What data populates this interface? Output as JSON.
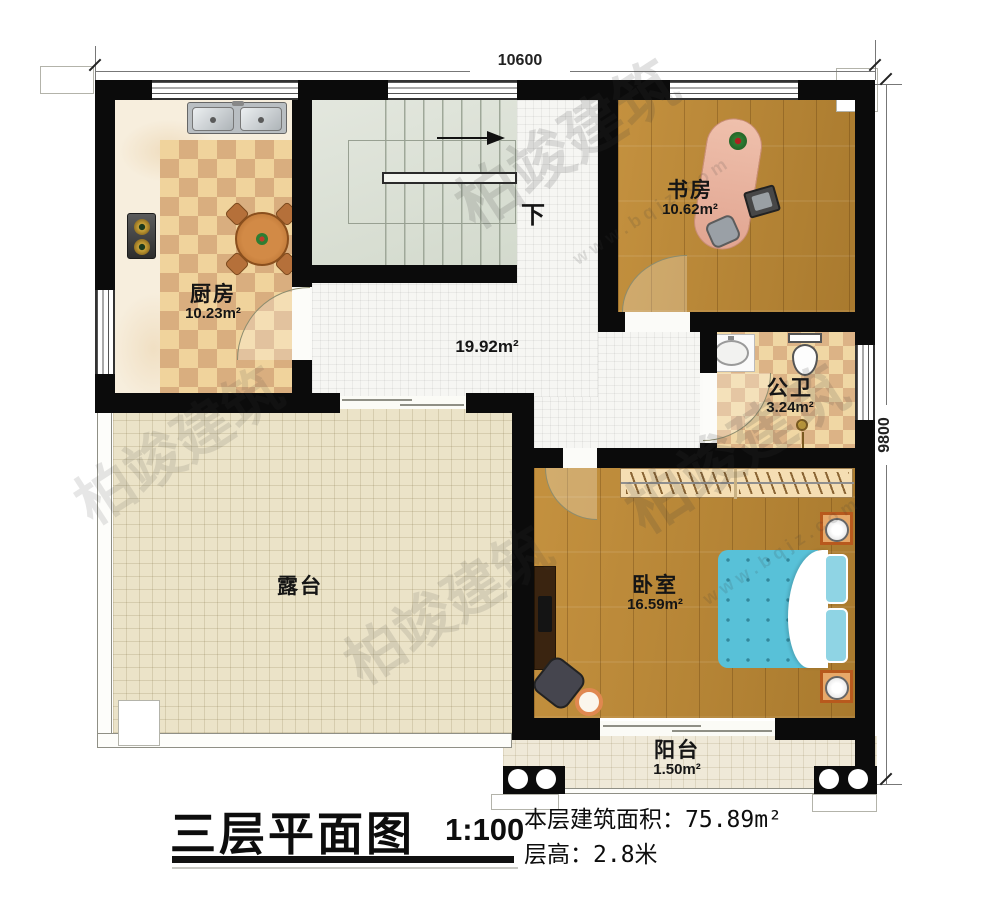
{
  "watermark": {
    "brand": "柏竣建筑",
    "url": "www.bqjz.com"
  },
  "dimensions": {
    "top": "10600",
    "right": "9800"
  },
  "stairs": {
    "direction_label": "下"
  },
  "rooms": {
    "kitchen": {
      "name": "厨房",
      "area": "10.23m²"
    },
    "study": {
      "name": "书房",
      "area": "10.62m²"
    },
    "bathroom": {
      "name": "公卫",
      "area": "3.24m²"
    },
    "bedroom": {
      "name": "卧室",
      "area": "16.59m²"
    },
    "terrace": {
      "name": "露台"
    },
    "balcony": {
      "name": "阳台",
      "area": "1.50m²"
    },
    "hallway": {
      "area": "19.92m²"
    }
  },
  "title_block": {
    "title": "三层平面图",
    "scale": "1:100",
    "floor_area_label": "本层建筑面积：",
    "floor_area_value": "75.89m²",
    "floor_height_label": "层高：",
    "floor_height_value": "2.8米"
  }
}
